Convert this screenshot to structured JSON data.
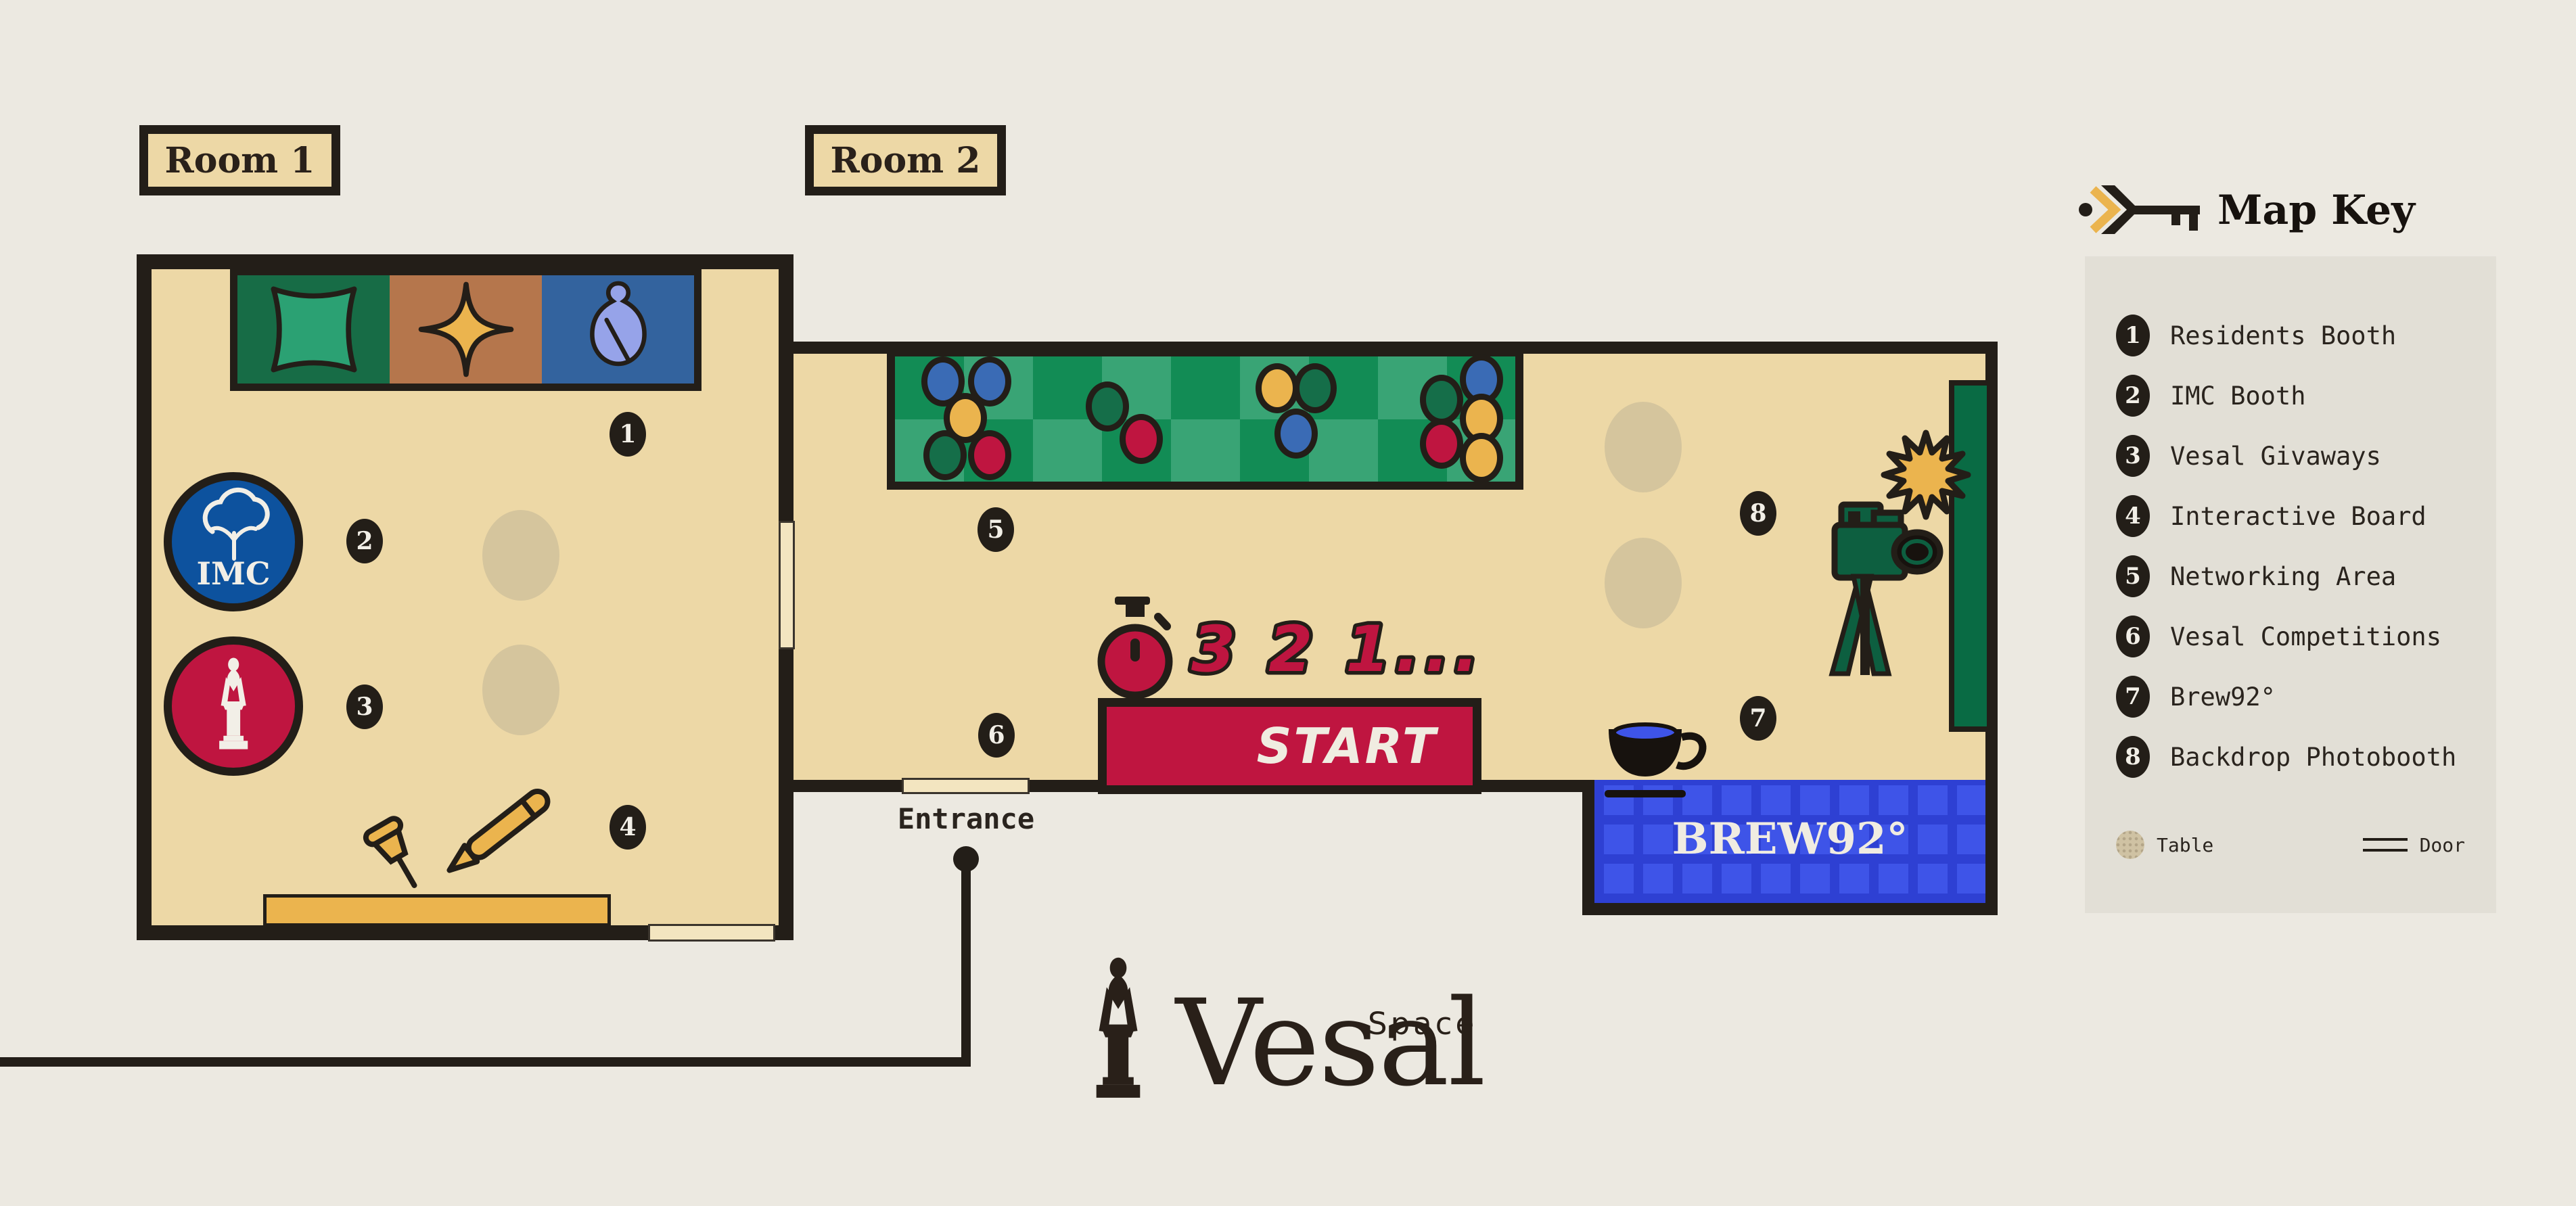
{
  "brand": {
    "name": "Vesal",
    "sub": "Space"
  },
  "rooms": {
    "room1": "Room 1",
    "room2": "Room 2"
  },
  "entrance": {
    "label": "Entrance"
  },
  "competition": {
    "countdown": "3 2 1...",
    "start": "START"
  },
  "cafe": {
    "name": "BREW92°"
  },
  "booths": {
    "imc": "IMC"
  },
  "map_key": {
    "title": "Map Key",
    "items": [
      {
        "num": "1",
        "label": "Residents Booth"
      },
      {
        "num": "2",
        "label": "IMC Booth"
      },
      {
        "num": "3",
        "label": "Vesal Givaways"
      },
      {
        "num": "4",
        "label": "Interactive Board"
      },
      {
        "num": "5",
        "label": "Networking Area"
      },
      {
        "num": "6",
        "label": "Vesal Competitions"
      },
      {
        "num": "7",
        "label": "Brew92°"
      },
      {
        "num": "8",
        "label": "Backdrop Photobooth"
      }
    ],
    "table_label": "Table",
    "door_label": "Door"
  },
  "colors": {
    "background": "#ECE9E1",
    "legend_bg": "#E2DFD6",
    "floor": "#EDD8A6",
    "wall": "#231E18",
    "crimson": "#BF1540",
    "gold": "#EBB44E",
    "rug_green_light": "#39A475",
    "rug_green_dark": "#128C55",
    "panel_green": "#176C46",
    "panel_brown": "#B5764C",
    "panel_blue": "#33639E",
    "imc_blue": "#0D529E",
    "cafe_blue": "#3E54E8",
    "cafe_blue_dark": "#2E40D3",
    "backdrop_green": "#096B44",
    "camera_green": "#0D5F40",
    "dot_blue": "#3A6BB5",
    "dot_green": "#156E49",
    "table_tan": "#D5C59D",
    "cream": "#F0ECE1"
  }
}
